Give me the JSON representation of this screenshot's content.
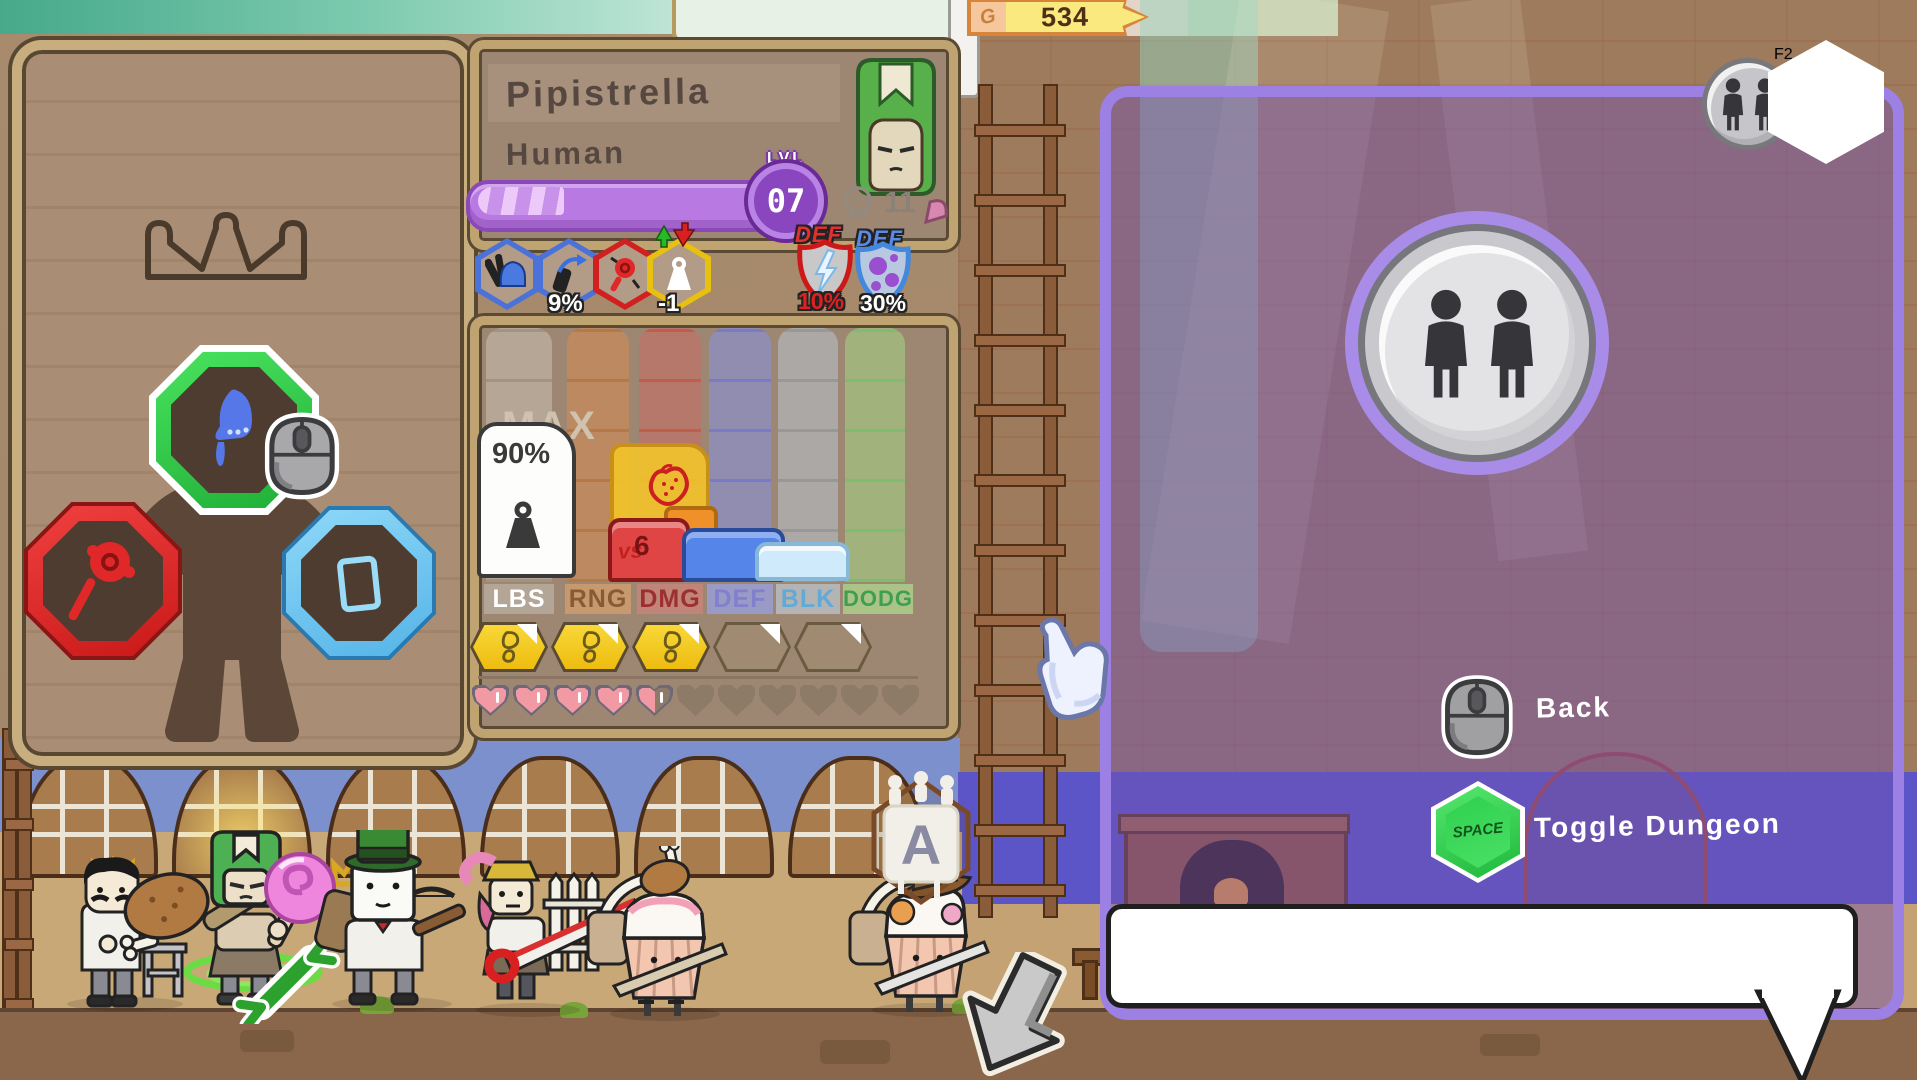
{
  "hud": {
    "gold_amount": "534",
    "gold_currency_letter": "G",
    "coop_join_key": "F2"
  },
  "character": {
    "name": "Pipistrella",
    "race": "Human",
    "level_label": "LVL",
    "level_value": "07",
    "skull_count": "11"
  },
  "modifiers": {
    "accuracy_value": "9%",
    "weight_modifier": "-1",
    "def_label_red": "DEF",
    "def_label_blue": "DEF",
    "lightning_defense": "10%",
    "poison_defense": "30%"
  },
  "stats": {
    "columns": [
      {
        "label": "LBS"
      },
      {
        "label": "RNG"
      },
      {
        "label": "DMG"
      },
      {
        "label": "DEF"
      },
      {
        "label": "BLK"
      },
      {
        "label": "DODG"
      }
    ],
    "lbs_value": "90%",
    "lbs_max_label": "MAX",
    "dmg_vs_label": "vs",
    "dmg_value": "6",
    "movement_slots_filled": 3,
    "movement_slots_total": 5,
    "hearts_full": 4,
    "hearts_half": 1,
    "hearts_total": 11
  },
  "dungeon_panel": {
    "back_label": "Back",
    "space_key_label": "Space",
    "toggle_label": "Toggle Dungeon"
  },
  "arena_banner": {
    "letter": "A"
  },
  "colors": {
    "panel_purple": "#9d80e4",
    "gold_yellow": "#f2c818",
    "level_purple": "#a864d8",
    "hp_pink": "#f29aa4",
    "slot_green": "#2ece4a",
    "slot_red": "#e02020",
    "slot_blue": "#70c8f0"
  }
}
